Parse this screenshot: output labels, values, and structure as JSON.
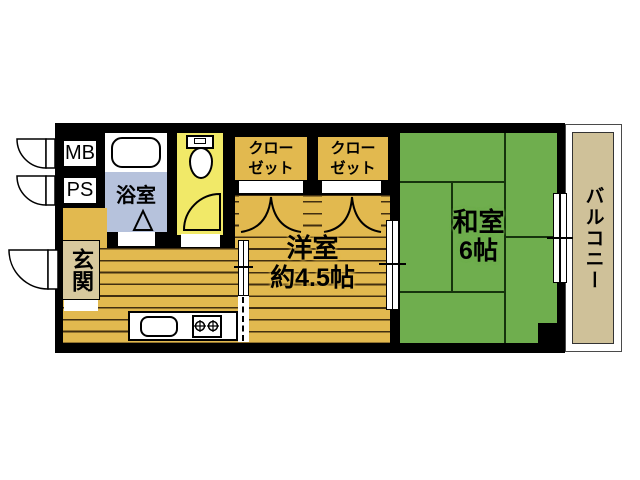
{
  "floorplan": {
    "type": "apartment-floor-plan",
    "rooms": {
      "mb": {
        "label": "MB"
      },
      "ps": {
        "label": "PS"
      },
      "bathroom": {
        "label": "浴室"
      },
      "entrance": {
        "label": "玄関"
      },
      "closet1": {
        "line1": "クロー",
        "line2": "ゼット"
      },
      "closet2": {
        "line1": "クロー",
        "line2": "ゼット"
      },
      "western_room": {
        "label": "洋室",
        "size": "約4.5帖"
      },
      "japanese_room": {
        "label": "和室",
        "size": "6帖"
      },
      "balcony": {
        "label": "バルコニー"
      }
    },
    "icons": {
      "bathtub": "rounded-rect outline",
      "toilet": "tank + bowl ellipse",
      "sink": "rounded-rect outline",
      "stove_burners": "two cross-circles",
      "swing_door": "quarter-circle arc",
      "sliding_window": "double white panel with tick",
      "bifold_closet_door": "double arc peak",
      "bath_door": "triangle mark",
      "room_divider": "vertical dashed line"
    },
    "colors": {
      "wall": "#000000",
      "flooring": "#e2b94f",
      "tatami_green": "#6fae4e",
      "toilet_yellow": "#f1e968",
      "bathroom_blue": "#b6c2dc",
      "entrance_tan": "#d8c99e",
      "balcony_tan": "#cfc199"
    }
  }
}
